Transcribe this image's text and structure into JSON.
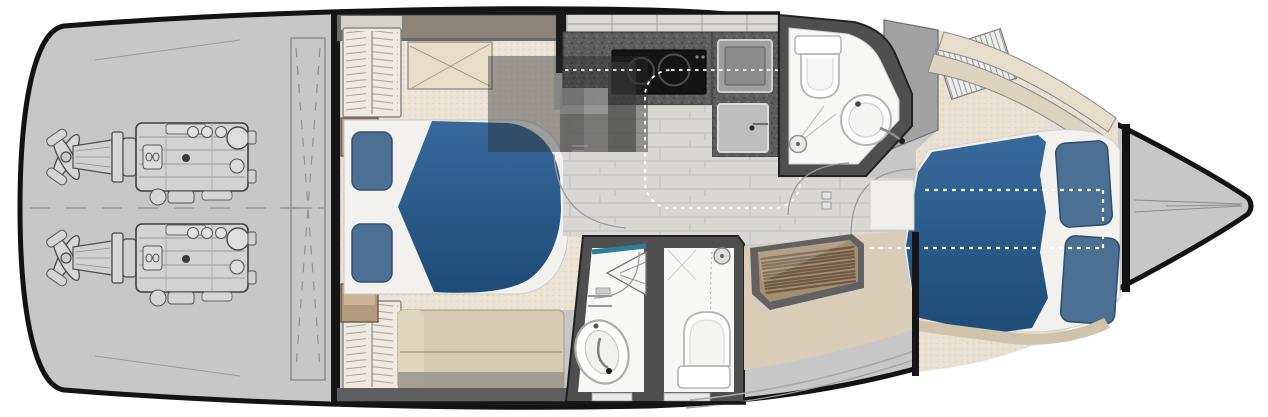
{
  "canvas": {
    "width": 1268,
    "height": 417
  },
  "diagram_type": "yacht-lower-deck-floor-plan",
  "colors": {
    "background": "#ffffff",
    "hull": "#c7c7c7",
    "outline": "#131313",
    "bulkhead": "#161616",
    "wall": "#4f4f4f",
    "wall_light": "#6a6a6a",
    "window_band": "#d9d8d4",
    "accent_band_brown": "#8e8377",
    "carpet": "#ece3d4",
    "carpet_fwd": "#e9e0d1",
    "bedding_white": "#f2f1ee",
    "pillow_blue": "#4c7094",
    "duvet_blue": "#2e6290",
    "nightstand_wood": "#b39a7d",
    "sofa_tan": "#d6cab2",
    "bench_beige": "#e9ddc8",
    "cooktop_black": "#141414",
    "sink_gray": "#9f9f9f",
    "bath_floor": "#f7f7f6",
    "fixture_white": "#ffffff",
    "teal_accent": "#2e7d96",
    "stairs_wood": "#a58e6f",
    "stairs_slat": "#6d5a44",
    "tan_floor": "#d9cdb7",
    "upholstery": "#e7ddcb",
    "plank_floor": "#d8d7d4",
    "locker_gray": "#a2a2a2",
    "shadow_overlay": "rgba(42,42,42,0.42)",
    "door_arc": "#9a9a9a",
    "dash_white": "#ffffff",
    "engine_line": "#4a4a4a",
    "hatch_line": "#8f8f8f"
  },
  "features": [
    {
      "name": "hull-outline"
    },
    {
      "name": "engine-room"
    },
    {
      "name": "twin-engines-with-sterndrives"
    },
    {
      "name": "transom-hatch"
    },
    {
      "name": "aft-cabin-double-bed"
    },
    {
      "name": "wardrobes-louvered"
    },
    {
      "name": "aft-cabin-sofa"
    },
    {
      "name": "galley-counter-cooktop-sink"
    },
    {
      "name": "aft-bathroom-toilet-shower-basin"
    },
    {
      "name": "day-head-toilet-basin-shower"
    },
    {
      "name": "companionway-wood-stairs"
    },
    {
      "name": "corridor-plank-floor"
    },
    {
      "name": "forward-cabin-double-bed"
    },
    {
      "name": "bow-deck"
    }
  ]
}
